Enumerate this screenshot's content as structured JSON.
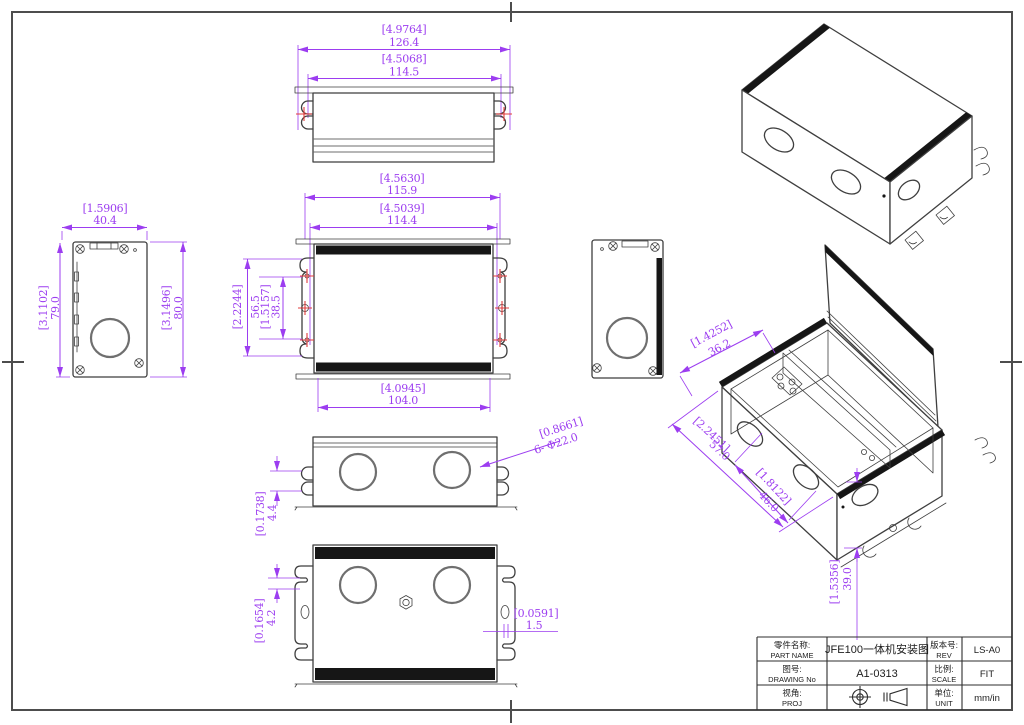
{
  "colors": {
    "dimension_purple": "#9c3df0",
    "drawing_line": "#3f3f3f",
    "hole_marker_red": "#e23c3c",
    "flange_black": "#161616"
  },
  "dims": {
    "top_outer_in": "[4.9764]",
    "top_outer_mm": "126.4",
    "top_inner_in": "[4.5068]",
    "top_inner_mm": "114.5",
    "front_w1_in": "[4.5630]",
    "front_w1_mm": "115.9",
    "front_w2_in": "[4.5039]",
    "front_w2_mm": "114.4",
    "front_w3_in": "[4.0945]",
    "front_w3_mm": "104.0",
    "front_h1_in": "[2.2244]",
    "front_h1_mm": "56.5",
    "front_h2_in": "[1.5157]",
    "front_h2_mm": "38.5",
    "side_w_in": "[1.5906]",
    "side_w_mm": "40.4",
    "side_h1_in": "[3.1102]",
    "side_h1_mm": "79.0",
    "side_h2_in": "[3.1496]",
    "side_h2_mm": "80.0",
    "hole_in": "[0.8661]",
    "hole_mm": "6- Φ22.0",
    "gap1_in": "[0.1738]",
    "gap1_mm": "4.4",
    "gap2_in": "[0.1654]",
    "gap2_mm": "4.2",
    "thk_in": "[0.0591]",
    "thk_mm": "1.5",
    "iso1_in": "[1.4252]",
    "iso1_mm": "36.2",
    "iso2_in": "[2.2451]",
    "iso2_mm": "57.0",
    "iso3_in": "[1.8122]",
    "iso3_mm": "46.0",
    "iso4_in": "[1.5356]",
    "iso4_mm": "39.0"
  },
  "title_block": {
    "part_name_label_cn": "零件名称:",
    "part_name_label_en": "PART NAME",
    "part_name_value": "JFE100一体机安装图",
    "rev_label_cn": "版本号:",
    "rev_label_en": "REV",
    "rev_value": "LS-A0",
    "drawing_no_label_cn": "图号:",
    "drawing_no_label_en": "DRAWING No",
    "drawing_no_value": "A1-0313",
    "scale_label_cn": "比例:",
    "scale_label_en": "SCALE",
    "scale_value": "FIT",
    "proj_label_cn": "视角:",
    "proj_label_en": "PROJ",
    "unit_label_cn": "单位:",
    "unit_label_en": "UNIT",
    "unit_value": "mm/in"
  }
}
